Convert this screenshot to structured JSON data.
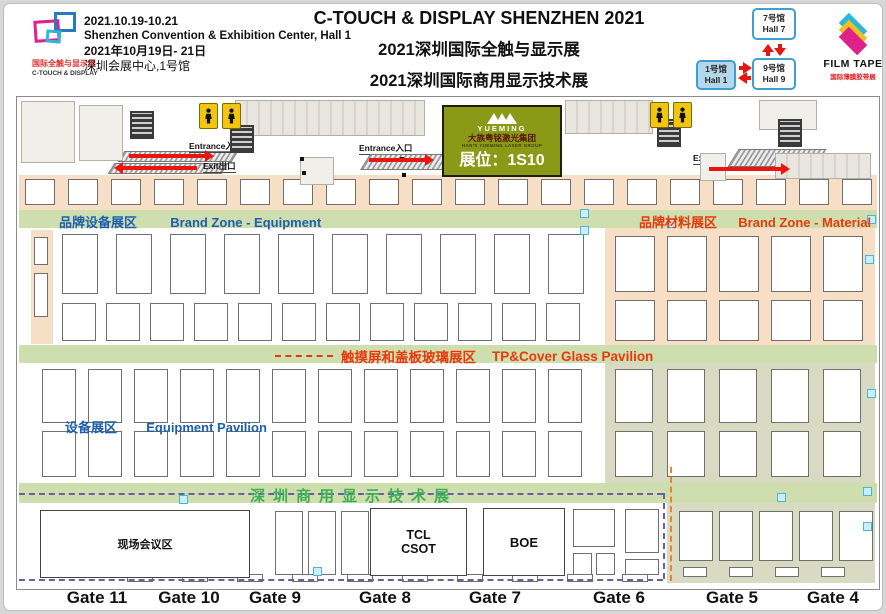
{
  "header": {
    "logo_cn": "国际全触与显示展",
    "logo_en": "C-TOUCH & DISPLAY",
    "date_range": "2021.10.19-10.21",
    "venue_en": "Shenzhen Convention & Exhibition Center, Hall 1",
    "date_cn": "2021年10月19日- 21日",
    "venue_cn": "深圳会展中心,1号馆",
    "title": "C-TOUCH & DISPLAY SHENZHEN 2021",
    "subtitle_touch": "2021深圳国际全触与显示展",
    "subtitle_commercial": "2021深圳国际商用显示技术展",
    "hall_nav": {
      "hall7_cn": "7号馆",
      "hall7_en": "Hall 7",
      "hall1_cn": "1号馆",
      "hall1_en": "Hall 1",
      "hall9_cn": "9号馆",
      "hall9_en": "Hall 9"
    },
    "film_tape_name": "FILM TAPE",
    "film_tape_cn": "国际薄膜胶带展"
  },
  "ad_banner": {
    "brand": "YUEMING",
    "group_cn": "大族粤铭激光集团",
    "group_en": "HAN'S YUEMING LASER GROUP",
    "booth_no": "展位：1S10"
  },
  "zones": {
    "brand_equipment_cn": "品牌设备展区",
    "brand_equipment_en": "Brand Zone - Equipment",
    "brand_material_cn": "品牌材料展区",
    "brand_material_en": "Brand Zone - Material",
    "tp_cover_cn": "触摸屏和盖板玻璃展区",
    "tp_cover_en": "TP&Cover Glass Pavilion",
    "equipment_cn": "设备展区",
    "equipment_en": "Equipment Pavilion",
    "commercial_cn": "深圳商用显示技术展"
  },
  "wayfinding": {
    "entrance": "Entrance入口",
    "exit": "Exit出口"
  },
  "named_booths": {
    "conference": "现场会议区",
    "tcl": "TCL CSOT",
    "boe": "BOE"
  },
  "gates": [
    "Gate 11",
    "Gate 10",
    "Gate 9",
    "Gate 8",
    "Gate 7",
    "Gate 6",
    "Gate 5",
    "Gate 4"
  ],
  "colors": {
    "band_green": "#cfdeae",
    "booth_peach": "#f7dfc6",
    "sage": "#d8dbc2",
    "accent_red": "#e8380d",
    "accent_blue": "#1d5fae",
    "commercial_green": "#3fae5a",
    "dash_purple": "#6a5fa0",
    "dash_orange": "#f08030",
    "yueming_olive": "#8b9a16",
    "hall_blue": "#3f9fd0"
  },
  "map": {
    "booth_rows": [
      {
        "x": 8,
        "y": 82,
        "w": 30,
        "h": 26,
        "step": 43,
        "n": 20
      },
      {
        "x": 17,
        "y": 140,
        "w": 14,
        "h": 28,
        "step": 0,
        "n": 1
      },
      {
        "x": 17,
        "y": 176,
        "w": 14,
        "h": 44,
        "step": 0,
        "n": 1
      },
      {
        "x": 45,
        "y": 137,
        "w": 36,
        "h": 60,
        "step": 54,
        "n": 10
      },
      {
        "x": 45,
        "y": 206,
        "w": 34,
        "h": 38,
        "step": 44,
        "n": 12
      },
      {
        "x": 598,
        "y": 139,
        "w": 40,
        "h": 56,
        "step": 52,
        "n": 5
      },
      {
        "x": 598,
        "y": 203,
        "w": 40,
        "h": 41,
        "step": 52,
        "n": 5
      },
      {
        "x": 25,
        "y": 272,
        "w": 34,
        "h": 54,
        "step": 46,
        "n": 12
      },
      {
        "x": 598,
        "y": 272,
        "w": 38,
        "h": 54,
        "step": 52,
        "n": 5
      },
      {
        "x": 25,
        "y": 334,
        "w": 34,
        "h": 46,
        "step": 46,
        "n": 12
      },
      {
        "x": 598,
        "y": 334,
        "w": 38,
        "h": 46,
        "step": 52,
        "n": 5
      },
      {
        "x": 258,
        "y": 414,
        "w": 28,
        "h": 64,
        "step": 33,
        "n": 3
      },
      {
        "x": 556,
        "y": 412,
        "w": 42,
        "h": 38,
        "step": 0,
        "n": 1
      },
      {
        "x": 556,
        "y": 456,
        "w": 19,
        "h": 22,
        "step": 23,
        "n": 2
      },
      {
        "x": 608,
        "y": 412,
        "w": 34,
        "h": 44,
        "step": 0,
        "n": 1
      },
      {
        "x": 608,
        "y": 462,
        "w": 34,
        "h": 16,
        "step": 0,
        "n": 1
      },
      {
        "x": 662,
        "y": 414,
        "w": 34,
        "h": 50,
        "step": 40,
        "n": 5
      },
      {
        "x": 666,
        "y": 470,
        "w": 24,
        "h": 10,
        "step": 46,
        "n": 4
      },
      {
        "x": 110,
        "y": 477,
        "w": 26,
        "h": 8,
        "step": 55,
        "n": 10
      }
    ],
    "structures": [
      {
        "x": 4,
        "y": 4,
        "w": 54,
        "h": 62,
        "t": "room"
      },
      {
        "x": 62,
        "y": 8,
        "w": 44,
        "h": 56,
        "t": "room"
      },
      {
        "x": 218,
        "y": 3,
        "w": 190,
        "h": 36,
        "t": "plant"
      },
      {
        "x": 548,
        "y": 3,
        "w": 88,
        "h": 34,
        "t": "plant"
      },
      {
        "x": 742,
        "y": 3,
        "w": 58,
        "h": 30,
        "t": "room"
      },
      {
        "x": 758,
        "y": 56,
        "w": 96,
        "h": 26,
        "t": "plant"
      },
      {
        "x": 283,
        "y": 60,
        "w": 34,
        "h": 28,
        "t": "room"
      },
      {
        "x": 683,
        "y": 56,
        "w": 26,
        "h": 28,
        "t": "room"
      }
    ],
    "stairs": [
      [
        113,
        14
      ],
      [
        213,
        28
      ],
      [
        452,
        22
      ],
      [
        640,
        22
      ],
      [
        761,
        22
      ]
    ],
    "restrooms": [
      [
        182,
        6
      ],
      [
        205,
        6
      ],
      [
        633,
        5
      ],
      [
        656,
        5
      ]
    ],
    "dots": [
      [
        283,
        60
      ],
      [
        383,
        60
      ],
      [
        285,
        74
      ],
      [
        385,
        76
      ]
    ],
    "cyan_markers": [
      [
        563,
        112
      ],
      [
        563,
        129
      ],
      [
        850,
        118
      ],
      [
        848,
        158
      ],
      [
        850,
        292
      ],
      [
        846,
        390
      ],
      [
        760,
        396
      ],
      [
        162,
        398
      ],
      [
        650,
        122
      ],
      [
        296,
        470
      ],
      [
        846,
        425
      ]
    ]
  }
}
